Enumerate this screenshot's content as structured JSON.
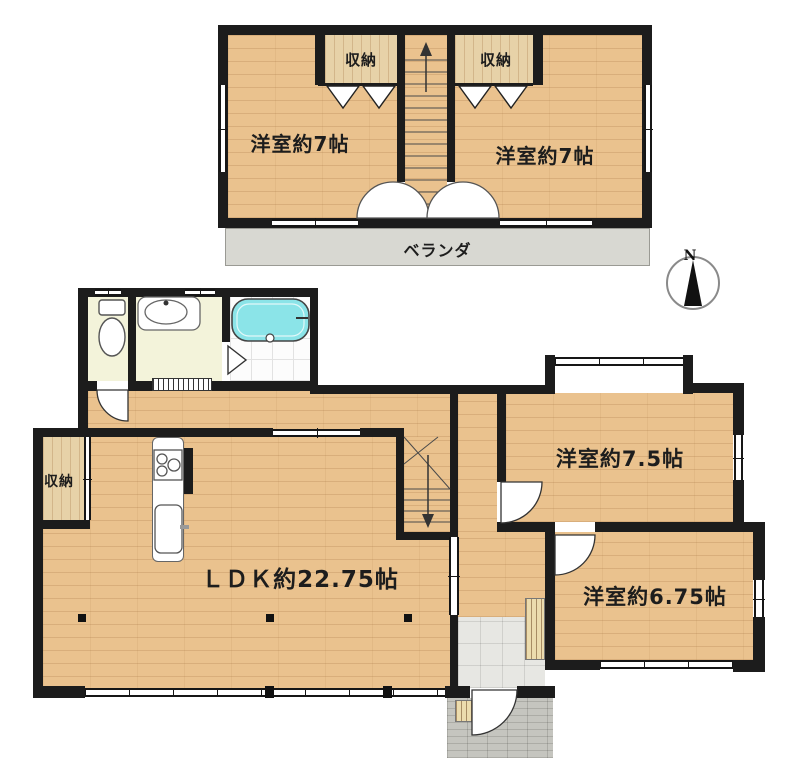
{
  "compass": {
    "label": "N"
  },
  "floor2": {
    "room_left": "洋室約7帖",
    "room_right": "洋室約7帖",
    "closet_left": "収納",
    "closet_right": "収納",
    "veranda": "ベランダ"
  },
  "floor1": {
    "ldk": "ＬＤＫ約22.75帖",
    "room_75": "洋室約7.5帖",
    "room_675": "洋室約6.75帖",
    "closet": "収納"
  },
  "colors": {
    "wall": "#1c1c1c",
    "wood": "#eac28e",
    "wood_light": "#e7d2a8",
    "sanitary": "#f3f3da",
    "bath_white": "#fcfcfc",
    "tile_gray": "#e7e7e3",
    "porch_gray": "#c5c5bf",
    "veranda_gray": "#d8d8d2",
    "tub": "#8be4e8"
  }
}
